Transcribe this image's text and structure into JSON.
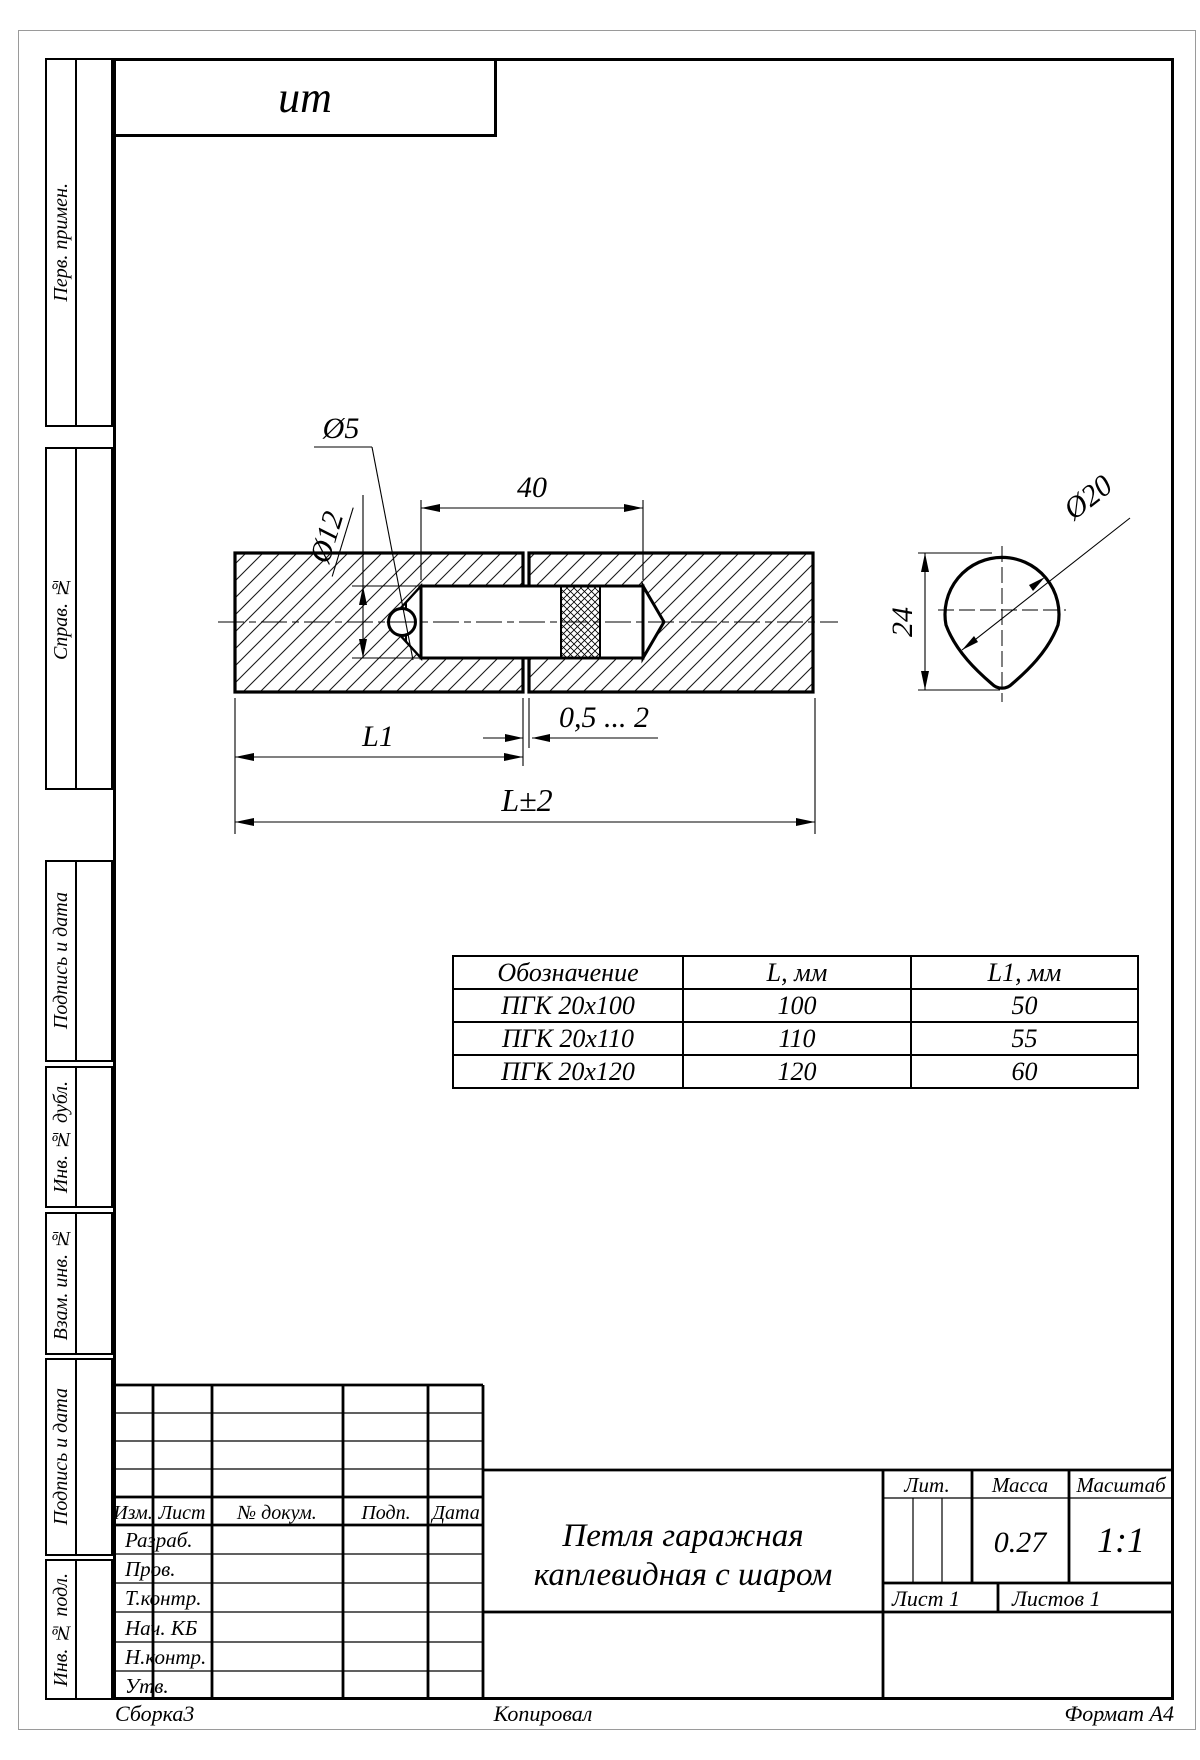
{
  "stamp": {
    "designation": "ит"
  },
  "margin_labels": {
    "perv": "Перв. примен.",
    "sprav": "Справ. №",
    "podpis1": "Подпись и дата",
    "inv_dubl": "Инв. № дубл.",
    "vzam": "Взам. инв. №",
    "podpis2": "Подпись и дата",
    "inv_podl": "Инв. № подл."
  },
  "drawing": {
    "dims": {
      "d5": "Ø5",
      "d12": "Ø12",
      "pin_length": "40",
      "l1": "L1",
      "gap": "0,5 ... 2",
      "overall": "L±2",
      "d20": "Ø20",
      "height24": "24"
    }
  },
  "size_table": {
    "headers": [
      "Обозначение",
      "L, мм",
      "L1, мм"
    ],
    "rows": [
      [
        "ПГК 20х100",
        "100",
        "50"
      ],
      [
        "ПГК 20х110",
        "110",
        "55"
      ],
      [
        "ПГК 20х120",
        "120",
        "60"
      ]
    ]
  },
  "title_block": {
    "title_line1": "Петля гаражная",
    "title_line2": "каплевидная с шаром",
    "lit_label": "Лит.",
    "mass_label": "Масса",
    "scale_label": "Масштаб",
    "mass_value": "0.27",
    "scale_value": "1:1",
    "sheet": "Лист 1",
    "sheets": "Листов 1",
    "change_header": [
      "Изм.",
      "Лист",
      "№ докум.",
      "Подп.",
      "Дата"
    ],
    "roles": [
      "Разраб.",
      "Пров.",
      "Т.контр.",
      "Нач. КБ",
      "Н.контр.",
      "Утв."
    ]
  },
  "footer": {
    "left": "Сборка3",
    "center": "Копировал",
    "right": "Формат А4"
  }
}
